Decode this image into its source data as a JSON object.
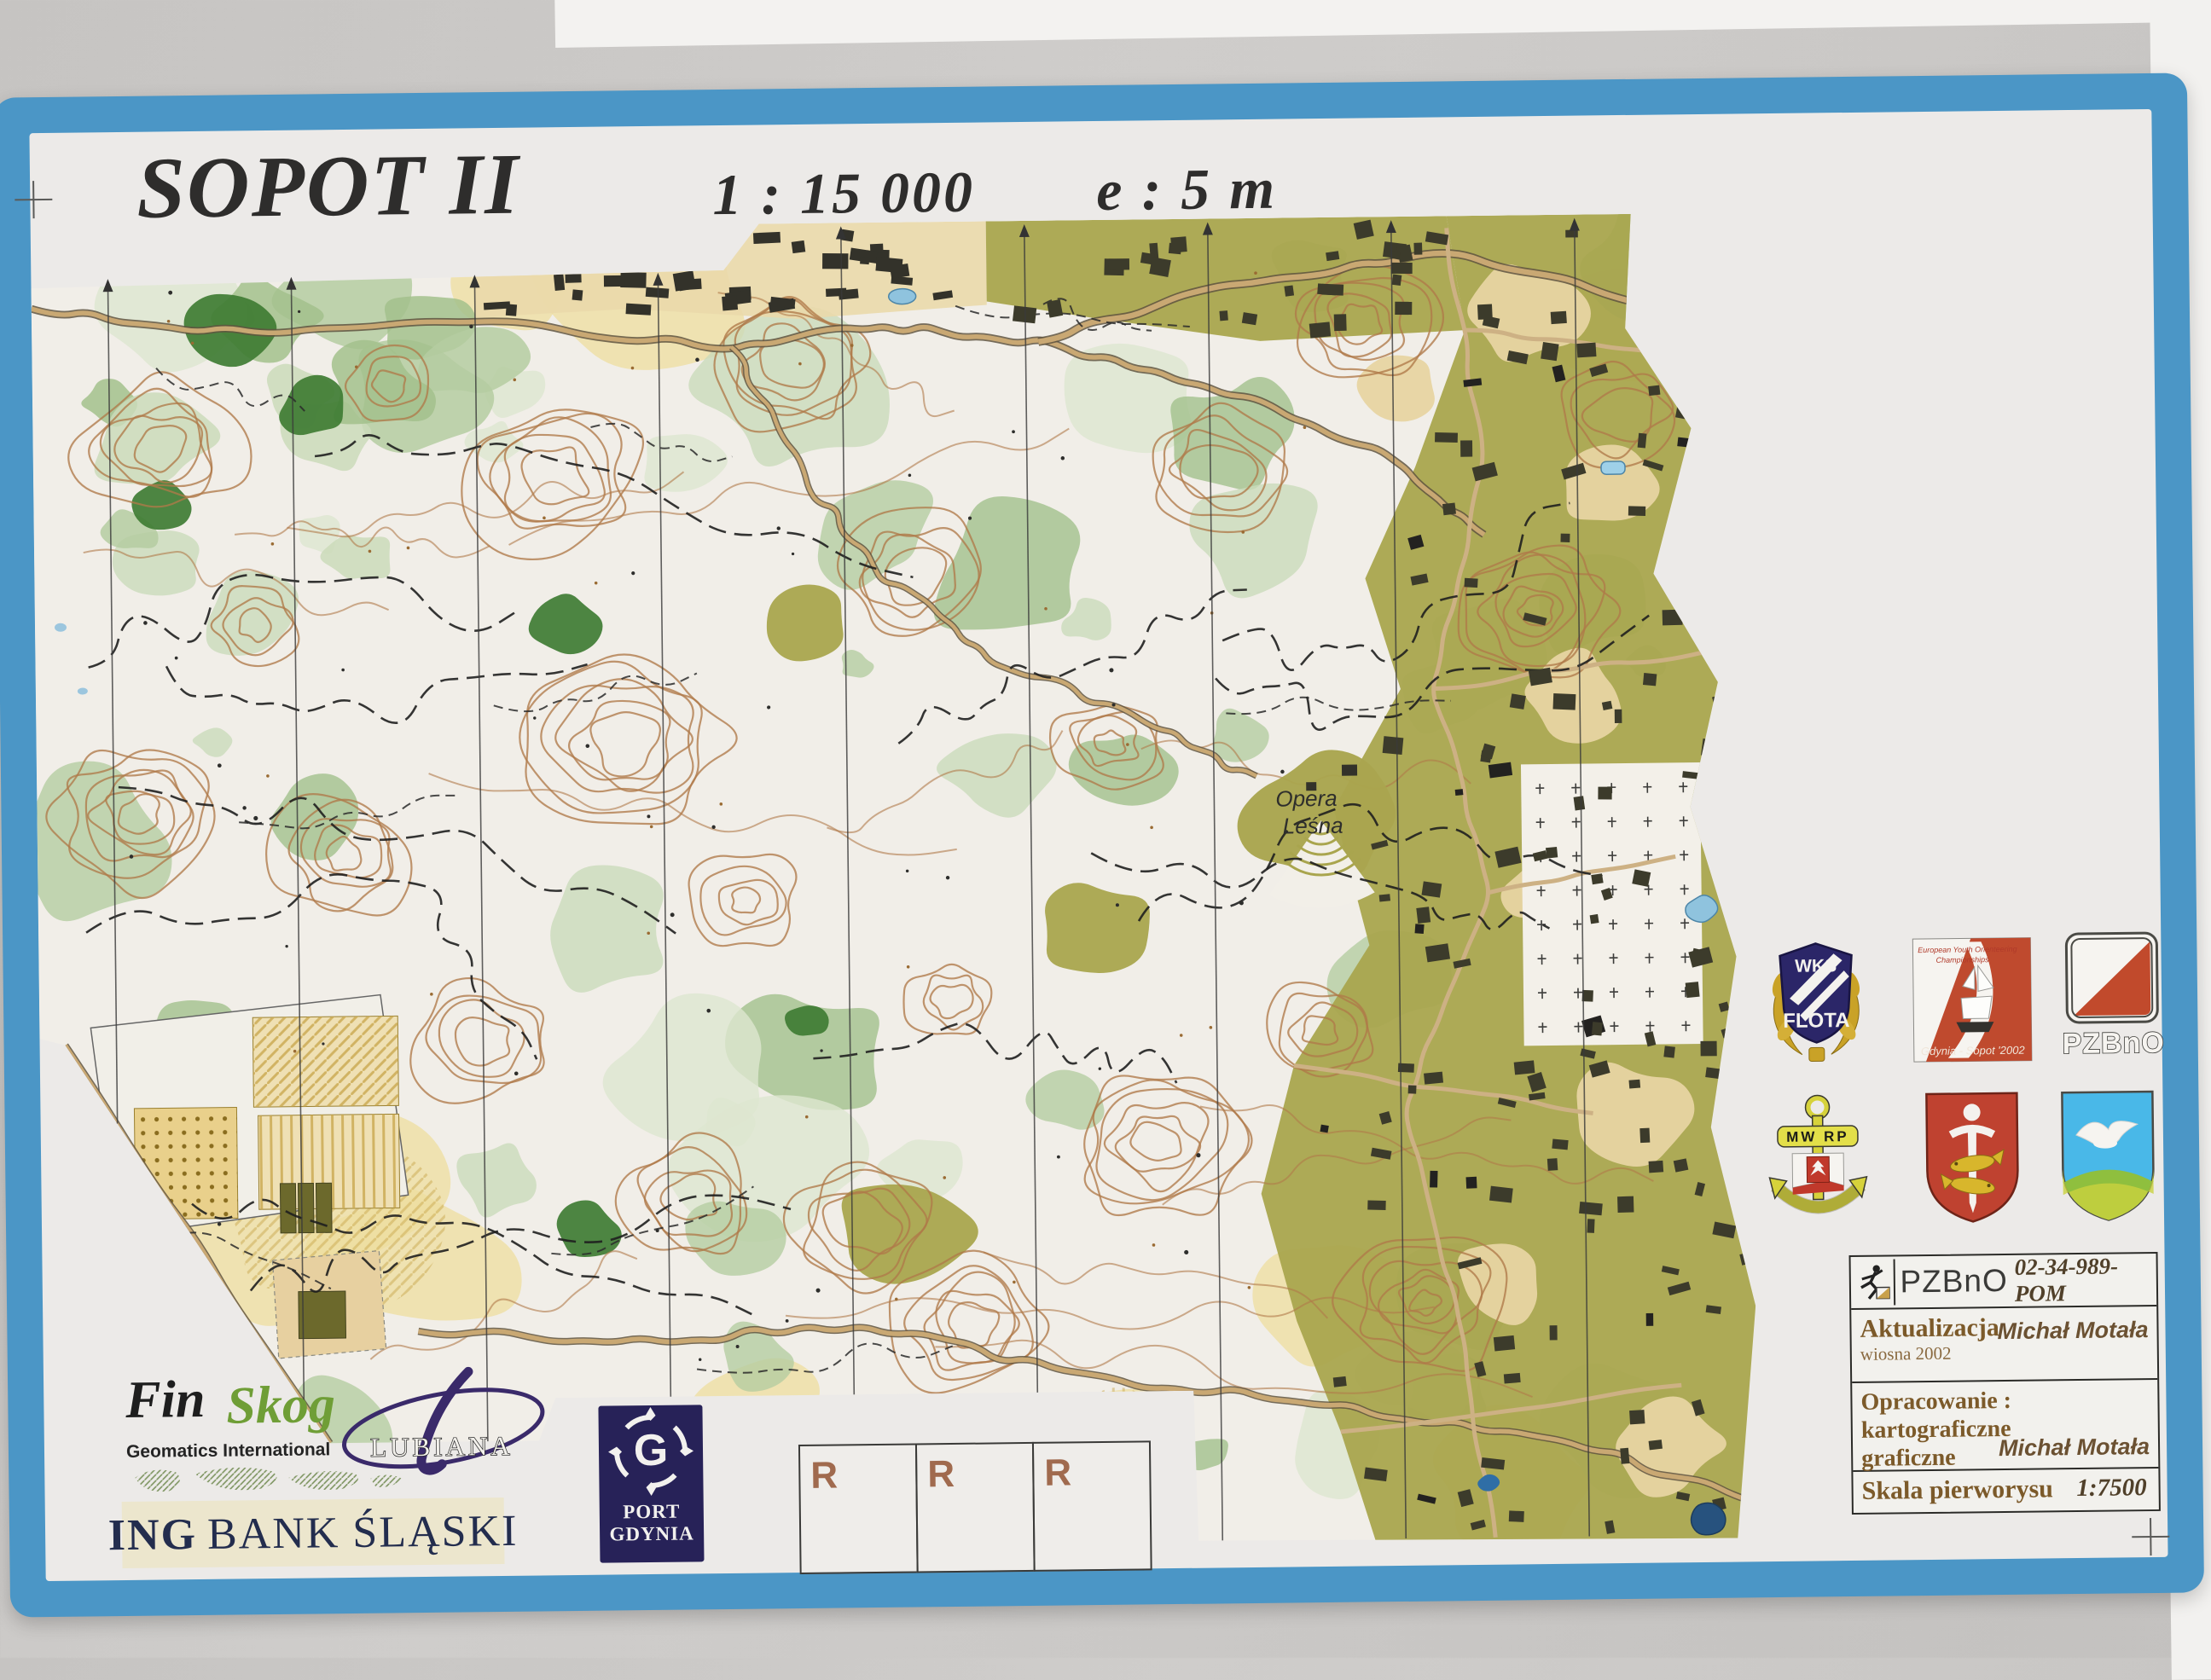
{
  "title": {
    "name": "SOPOT II",
    "scale": "1 : 15 000",
    "equidistance": "e :  5 m"
  },
  "map_labels": {
    "opera1": "Opera",
    "opera2": "Leśna"
  },
  "club_logos": {
    "flota": {
      "top": "WKS",
      "name": "FLOTA"
    },
    "eyoc": {
      "line1": "European Youth Orienteering",
      "line2": "Championships",
      "bottom": "Gdynia - Sopot '2002"
    },
    "pzbno_flag": {
      "label": "PZBnO"
    },
    "navy": {
      "label": "MW RP"
    }
  },
  "info_box": {
    "org": "PZBnO",
    "number": "02-34-989-POM",
    "update_label": "Aktualizacja",
    "update_season": "wiosna 2002",
    "update_author": "Michał Motała",
    "work_label": "Opracowanie :",
    "work_type1": "kartograficzne",
    "work_type2": "graficzne",
    "work_author": "Michał Motała",
    "base_scale_label": "Skala pierworysu",
    "base_scale_value": "1:7500"
  },
  "sponsors": {
    "finskog_word1": "Fin",
    "finskog_word2": "Skog",
    "finskog_sub": "Geomatics International",
    "lubiana": "LUBIANA",
    "ing_prefix": "ING",
    "ing_suffix": "BANK ŚLĄSKI",
    "port_line1": "PORT",
    "port_line2": "GDYNIA",
    "port_monogram": "G"
  },
  "reserve_boxes": [
    "R",
    "R",
    "R"
  ],
  "colors": {
    "border_blue": "#4b96c6",
    "paper": "#eceae8",
    "contour_brown": "#b07a49",
    "urban_olive": "#a9a54e",
    "forest_white": "#f1eee8",
    "water_blue": "#8fc3de",
    "flag_red": "#c14a2c",
    "info_text_brown": "#7c5a2a"
  }
}
